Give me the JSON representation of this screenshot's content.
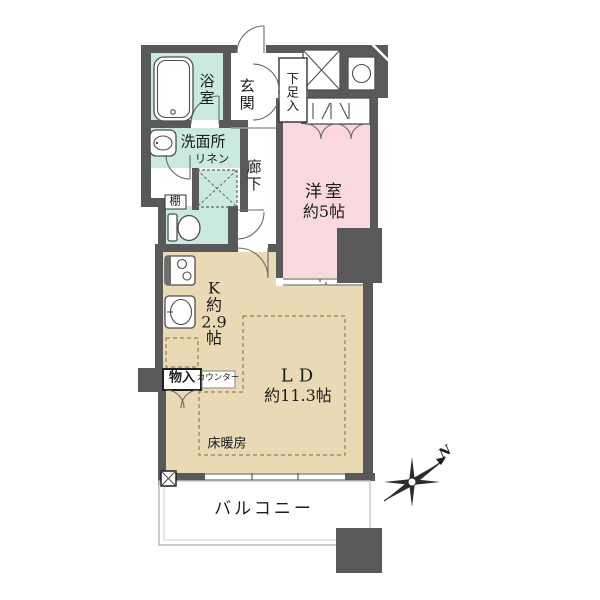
{
  "rooms": {
    "bath": {
      "label": "浴室"
    },
    "entrance": {
      "label": "玄関"
    },
    "shoe_box": {
      "label": "下足入"
    },
    "washroom": {
      "label": "洗面所",
      "linen": "リネン"
    },
    "hallway": {
      "label": "廊下"
    },
    "bedroom": {
      "label": "洋室",
      "size": "約5帖"
    },
    "kitchen": {
      "lines": [
        "K",
        "約",
        "2.9",
        "帖"
      ]
    },
    "living": {
      "label": "LD",
      "size": "約11.3帖"
    },
    "storage": {
      "label": "物入"
    },
    "counter": {
      "label": "カウンター"
    },
    "shelf": {
      "label": "棚"
    },
    "floor_heating": {
      "label": "床暖房"
    },
    "balcony": {
      "label": "バルコニー"
    }
  },
  "compass": {
    "north_label": "N"
  },
  "colors": {
    "wall": "#595959",
    "wet_area": "#cbeadf",
    "bedroom": "#f9d8e0",
    "living_dining": "#e9d9b5",
    "floor_heating_dash": "#94824f",
    "balcony_border": "#b5b5b5"
  }
}
